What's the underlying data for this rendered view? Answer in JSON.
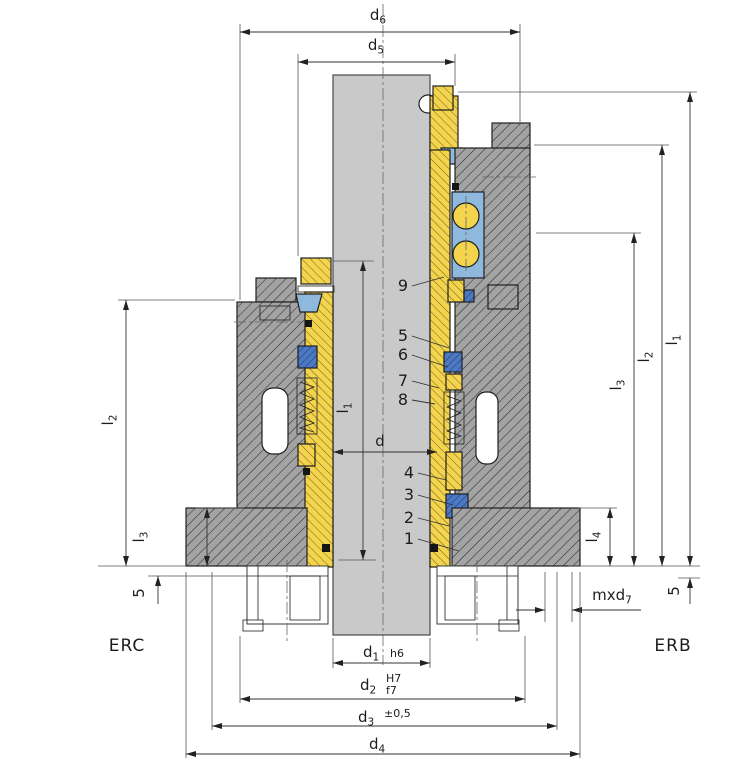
{
  "drawing": {
    "type": "mechanical-seal-cross-section",
    "variants": {
      "left": "ERC",
      "right": "ERB"
    }
  },
  "colors": {
    "housing_steel": "#a3a3a3",
    "shaft_gray": "#c9c9c9",
    "sleeve_brass": "#f3d44c",
    "seal_blue": "#4b79c4",
    "elastomer_light_blue": "#8fb9dc",
    "hatch_line": "#2e2e2e",
    "dimension_line": "#333333",
    "background": "#ffffff"
  },
  "dims": {
    "d6": {
      "label": "d",
      "sub": "6"
    },
    "d5": {
      "label": "d",
      "sub": "5"
    },
    "d1": {
      "label": "d",
      "sub": "1",
      "fit": "h6"
    },
    "d2": {
      "label": "d",
      "sub": "2",
      "fit_bore": "H7",
      "fit_shaft": "f7"
    },
    "d3": {
      "label": "d",
      "sub": "3",
      "tolerance": "±0,5"
    },
    "d4": {
      "label": "d",
      "sub": "4"
    },
    "d": {
      "label": "d"
    },
    "l1": {
      "label": "l",
      "sub": "1"
    },
    "l2": {
      "label": "l",
      "sub": "2"
    },
    "l3": {
      "label": "l",
      "sub": "3"
    },
    "l4": {
      "label": "l",
      "sub": "4"
    },
    "md7": {
      "label": "mxd",
      "sub": "7"
    },
    "clearance5": {
      "label": "5"
    }
  },
  "callouts": [
    "1",
    "2",
    "3",
    "4",
    "5",
    "6",
    "7",
    "8",
    "9"
  ]
}
